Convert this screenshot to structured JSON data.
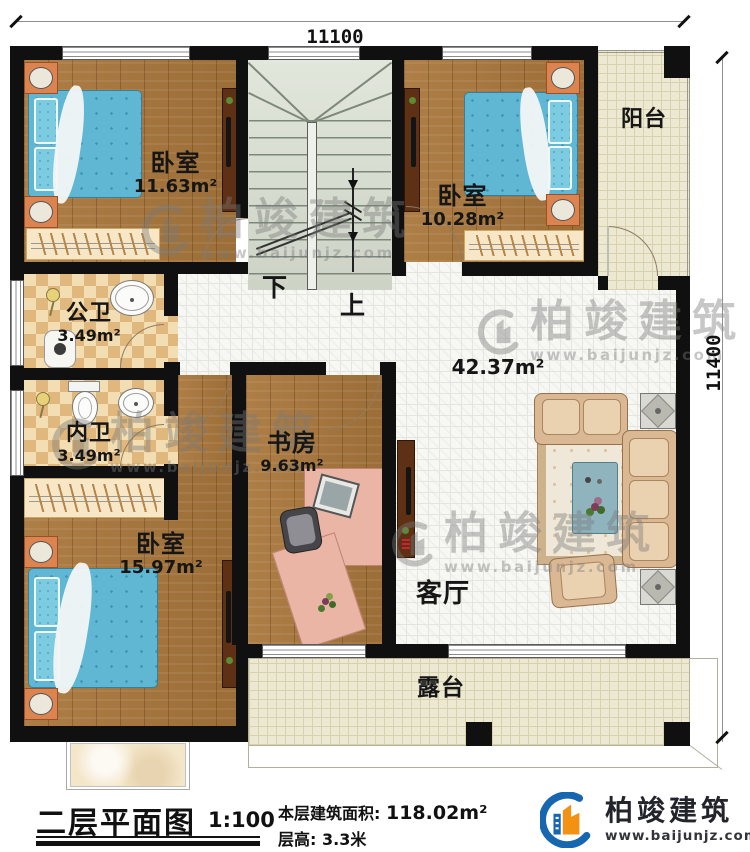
{
  "dimensions": {
    "top": "11100",
    "right": "11400"
  },
  "rooms": {
    "bedroom_tl": {
      "name": "卧室",
      "area": "11.63m²"
    },
    "bedroom_tr": {
      "name": "卧室",
      "area": "10.28m²"
    },
    "balcony": {
      "name": "阳台"
    },
    "public_bath": {
      "name": "公卫",
      "area": "3.49m²"
    },
    "private_bath": {
      "name": "内卫",
      "area": "3.49m²"
    },
    "study": {
      "name": "书房",
      "area": "9.63m²"
    },
    "bedroom_bl": {
      "name": "卧室",
      "area": "15.97m²"
    },
    "living": {
      "name": "客厅",
      "area": "42.37m²"
    },
    "terrace": {
      "name": "露台"
    }
  },
  "stairs": {
    "down_label": "下",
    "up_label": "上"
  },
  "watermark": {
    "brand": "柏竣建筑",
    "url": "www.baijunjz.com"
  },
  "titleblock": {
    "title": "二层平面图",
    "scale": "1:100",
    "area_label": "本层建筑面积:",
    "area_value": "118.02m²",
    "floor_height_label": "层高:",
    "floor_height_value": "3.3米"
  },
  "logo": {
    "brand": "柏竣建筑",
    "url": "www.baijunjz.com"
  },
  "colors": {
    "wall": "#101010",
    "wood": "#a9773c",
    "tile_white": "#f7f7f4",
    "tile_cream": "#ece8d1",
    "bath_tile": "#f2deb2",
    "bath_tile_alt": "#e0b87e",
    "stair_tile": "#d8ded0",
    "bed_blue": "#5fb7d3",
    "logo_blue": "#1766b0",
    "logo_orange": "#f39212"
  }
}
